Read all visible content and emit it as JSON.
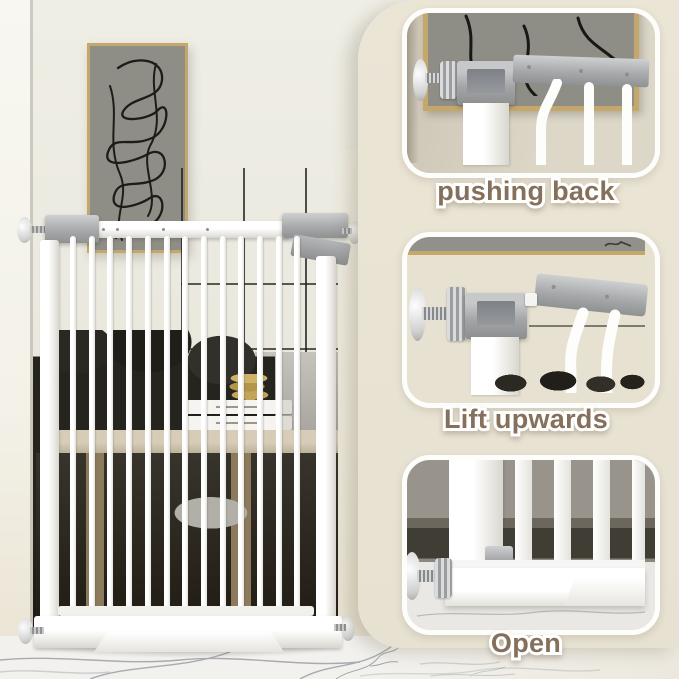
{
  "steps": [
    {
      "label": "pushing back"
    },
    {
      "label": "Lift upwards"
    },
    {
      "label": "Open"
    }
  ],
  "colors": {
    "caption-brown": "#85705b",
    "panel-border": "#fdfdfb",
    "frame-gold": "#c4a76a",
    "canvas-gray": "#8f8e86",
    "beige-column": "#e8e2d3",
    "latch-gray": "#a9abad",
    "gate-white": "#fcfcfb",
    "blanket-dark": "#26241f",
    "wood-tan": "#cbc1ab",
    "marble-vein": "#8b9094"
  }
}
